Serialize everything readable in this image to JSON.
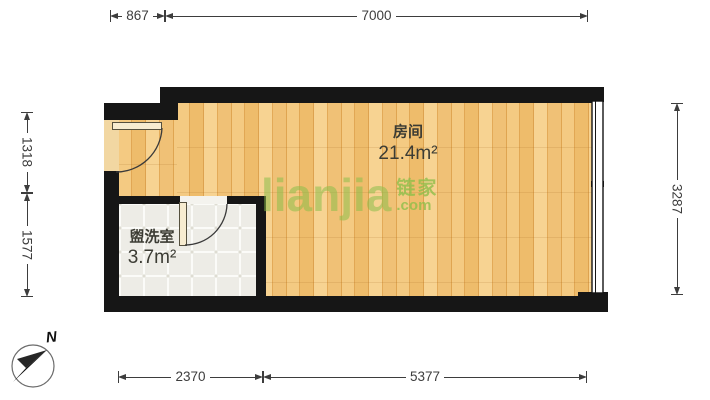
{
  "plan": {
    "rooms": [
      {
        "name": "房间",
        "area": "21.4m²"
      },
      {
        "name": "盥洗室",
        "area": "3.7m²"
      }
    ],
    "dims": {
      "top": [
        {
          "label": "867"
        },
        {
          "label": "7000"
        }
      ],
      "bottom": [
        {
          "label": "2370"
        },
        {
          "label": "5377"
        }
      ],
      "left": [
        {
          "label": "1318"
        },
        {
          "label": "1577"
        }
      ],
      "right": [
        {
          "label": "3287"
        }
      ]
    },
    "compass": {
      "label": "N"
    },
    "watermark": {
      "wordmark": "lianjia",
      "cjk": "链家",
      "tld": ".com"
    },
    "colors": {
      "wall": "#161616",
      "wood_floor": "#eebd6e",
      "tile_floor": "#edece6",
      "watermark_green": "#8dbe4a",
      "dimension_text": "#3d3d3d"
    }
  }
}
